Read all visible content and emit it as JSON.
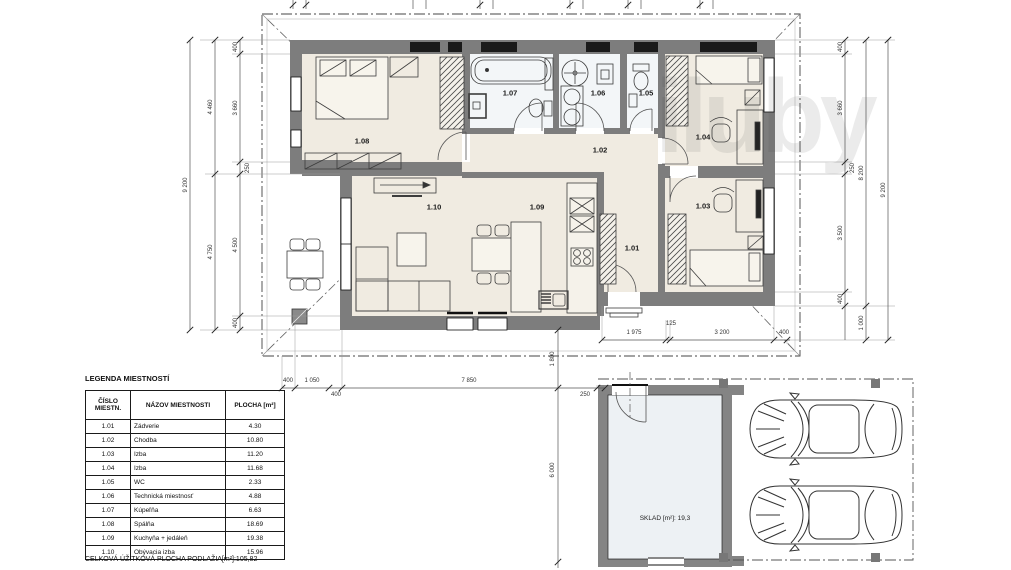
{
  "legend": {
    "title": "LEGENDA MIESTNOSTÍ",
    "col_num": "ČÍSLO MIESTN.",
    "col_name": "NÁZOV MIESTNOSTI",
    "col_area": "PLOCHA [m²]",
    "rows": [
      {
        "num": "1.01",
        "name": "Zádverie",
        "area": "4.30"
      },
      {
        "num": "1.02",
        "name": "Chodba",
        "area": "10.80"
      },
      {
        "num": "1.03",
        "name": "Izba",
        "area": "11.20"
      },
      {
        "num": "1.04",
        "name": "Izba",
        "area": "11.68"
      },
      {
        "num": "1.05",
        "name": "WC",
        "area": "2.33"
      },
      {
        "num": "1.06",
        "name": "Technická miestnosť",
        "area": "4.88"
      },
      {
        "num": "1.07",
        "name": "Kúpeľňa",
        "area": "6.63"
      },
      {
        "num": "1.08",
        "name": "Spálňa",
        "area": "18.69"
      },
      {
        "num": "1.09",
        "name": "Kuchyňa + jedáleň",
        "area": "19.38"
      },
      {
        "num": "1.10",
        "name": "Obývacia izba",
        "area": "15.96"
      }
    ],
    "footer": "CELKOVÁ ÚŽITKOVÁ PLOCHA PODLAŽIA[m²]:105,82"
  },
  "plan_labels": {
    "r1_01": "1.01",
    "r1_02": "1.02",
    "r1_03": "1.03",
    "r1_04": "1.04",
    "r1_05": "1.05",
    "r1_06": "1.06",
    "r1_07": "1.07",
    "r1_08": "1.08",
    "r1_09": "1.09",
    "r1_10": "1.10"
  },
  "sklad_label": "SKLAD [m²]: 19,3",
  "watermark": "iluby",
  "dims": {
    "left": {
      "outer": "9 200",
      "mid_top": "4 460",
      "mid_bottom": "4 750",
      "seg1": "400",
      "seg2": "3 660",
      "seg3": "250",
      "seg4": "4 500",
      "seg5": "400"
    },
    "right": {
      "outer": "9 200",
      "mid": "8 200",
      "porch": "1 000",
      "seg1": "400",
      "seg2": "3 660",
      "seg3": "250",
      "seg4": "3 500",
      "seg5": "400"
    },
    "bottom_house": {
      "seg1": "1 975",
      "seg2": "125",
      "seg3": "3 200",
      "seg4": "400"
    },
    "bottom_site": {
      "seg1": "400",
      "seg2": "1 050",
      "seg3": "400",
      "seg4": "7 850",
      "seg5": "250"
    },
    "site_vertical": {
      "seg1": "1 800",
      "seg2": "6 000"
    }
  },
  "colors": {
    "wall": "#7d7d7d",
    "room": "#f0ebe1",
    "wet_room": "#f3f6f8",
    "sklad_floor": "#edf1f4",
    "line": "#444444"
  }
}
